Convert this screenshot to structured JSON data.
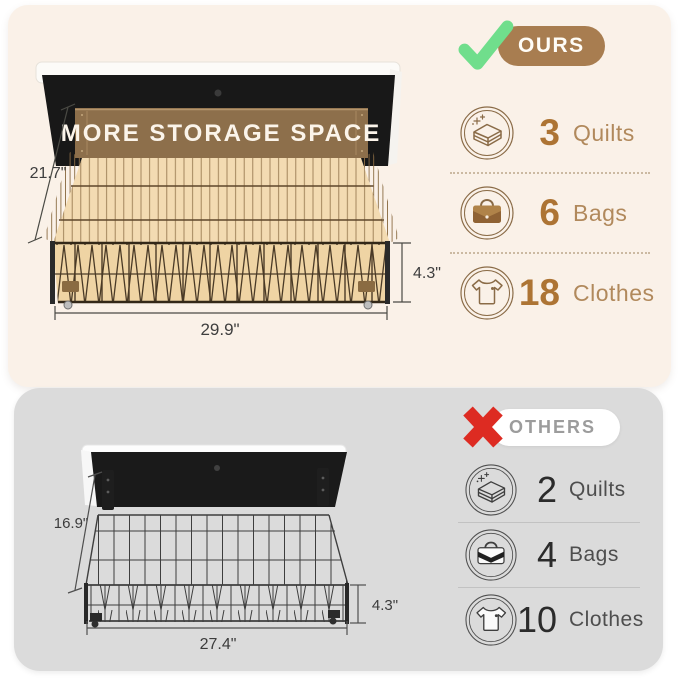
{
  "ours": {
    "badge_label": "OURS",
    "banner": "MORE STORAGE SPACE",
    "dimensions": {
      "depth": "21.7\"",
      "height": "4.3\"",
      "width": "29.9\""
    },
    "items": [
      {
        "icon": "quilt-icon",
        "count": "3",
        "label": "Quilts"
      },
      {
        "icon": "bag-icon",
        "count": "6",
        "label": "Bags"
      },
      {
        "icon": "clothes-icon",
        "count": "18",
        "label": "Clothes"
      }
    ],
    "colors": {
      "panel": "#FAF1E8",
      "accent": "#A87D50",
      "number": "#AD7434",
      "check": "#70DE8C"
    }
  },
  "others": {
    "badge_label": "OTHERS",
    "dimensions": {
      "depth": "16.9\"",
      "height": "4.3\"",
      "width": "27.4\""
    },
    "items": [
      {
        "icon": "quilt-icon",
        "count": "2",
        "label": "Quilts"
      },
      {
        "icon": "bag-icon",
        "count": "4",
        "label": "Bags"
      },
      {
        "icon": "clothes-icon",
        "count": "10",
        "label": "Clothes"
      }
    ],
    "colors": {
      "panel": "#DBDBDB",
      "x": "#DD2B22",
      "number": "#2B2B2B"
    }
  }
}
